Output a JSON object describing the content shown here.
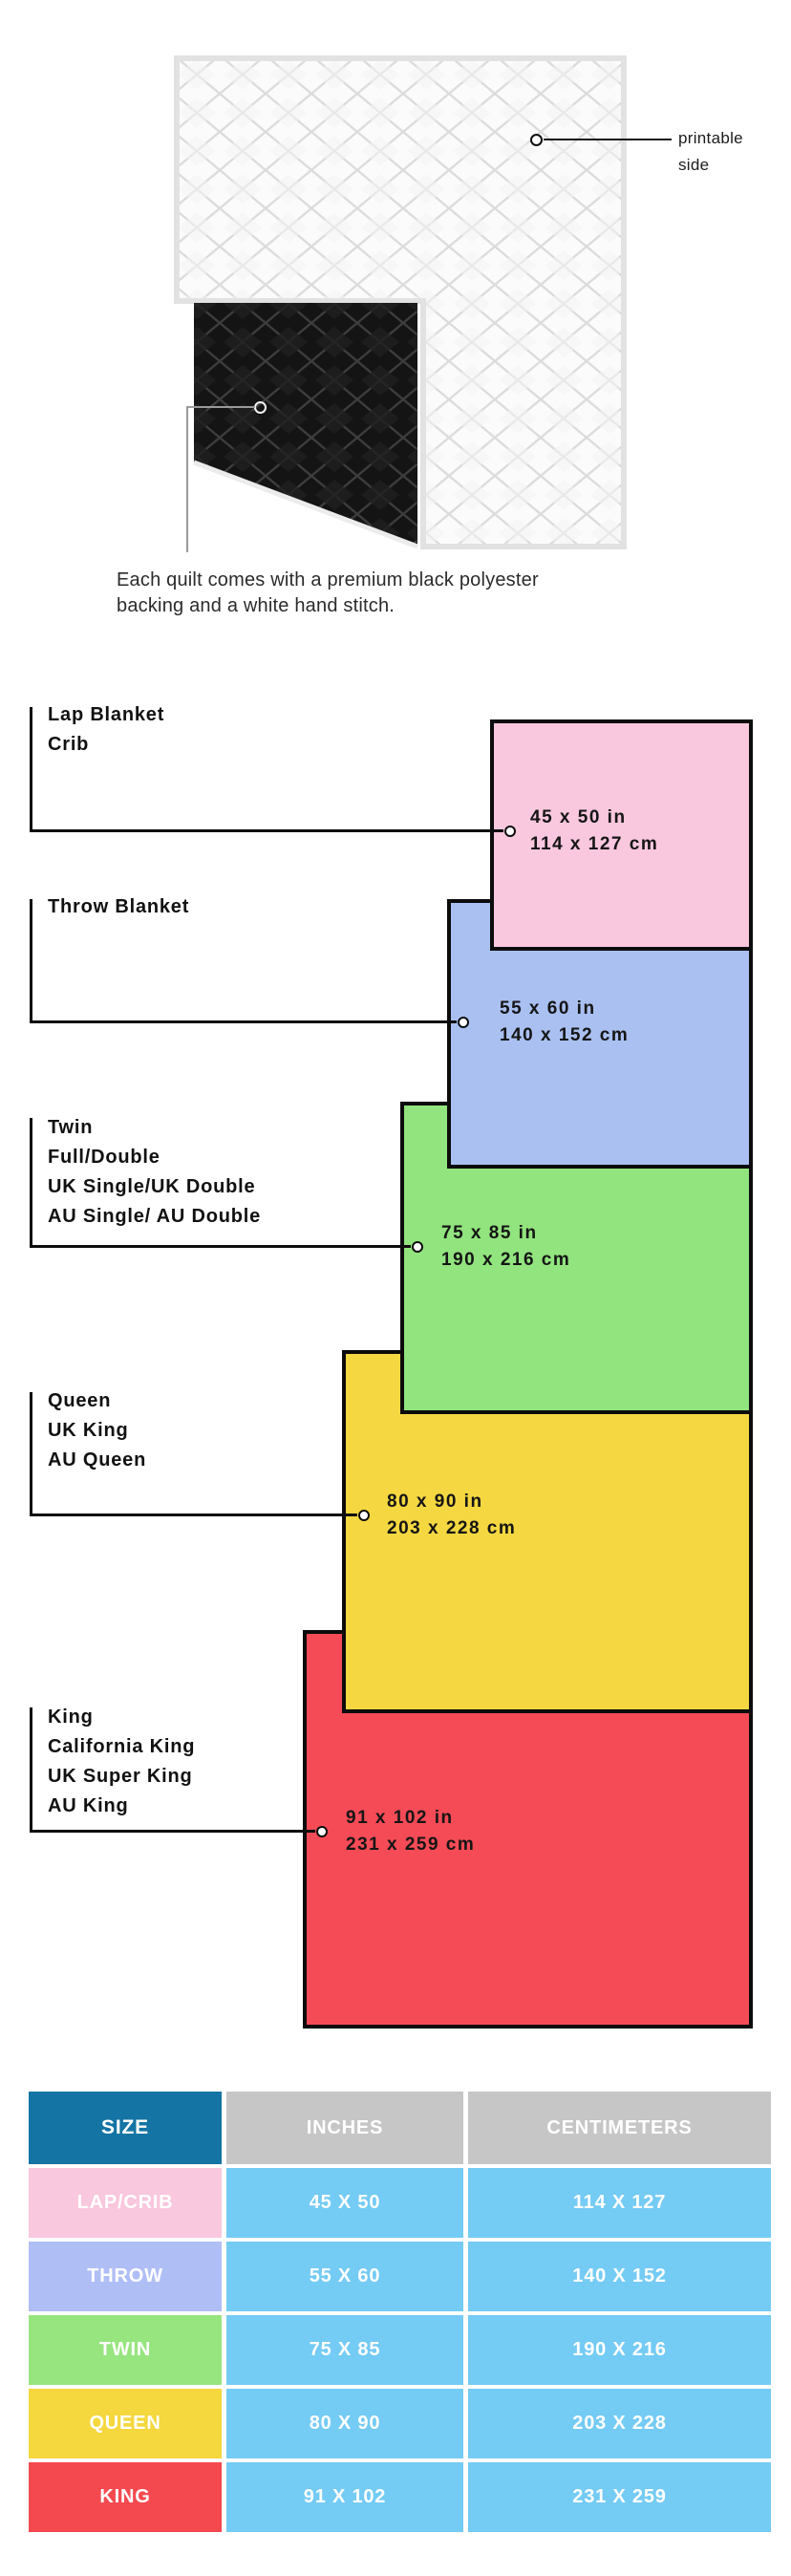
{
  "illustration": {
    "printable_side": {
      "line1": "printable",
      "line2": "side"
    },
    "caption_line1": "Each quilt comes with a premium black polyester",
    "caption_line2": "backing and a white hand stitch."
  },
  "diagram": {
    "sizes": [
      {
        "key": "lap",
        "label_lines": [
          "Lap Blanket",
          "Crib"
        ],
        "inches": "45 x 50 in",
        "cm": "114 x 127 cm",
        "fill": "#f9c7de"
      },
      {
        "key": "throw",
        "label_lines": [
          "Throw Blanket"
        ],
        "inches": "55 x 60 in",
        "cm": "140 x 152 cm",
        "fill": "#a9c0f1"
      },
      {
        "key": "twin",
        "label_lines": [
          "Twin",
          "Full/Double",
          "UK Single/UK Double",
          "AU Single/ AU Double"
        ],
        "inches": "75 x 85 in",
        "cm": "190 x 216 cm",
        "fill": "#92e47e"
      },
      {
        "key": "queen",
        "label_lines": [
          "Queen",
          "UK King",
          "AU Queen"
        ],
        "inches": "80 x 90 in",
        "cm": "203 x 228 cm",
        "fill": "#f5d841"
      },
      {
        "key": "king",
        "label_lines": [
          "King",
          "California King",
          "UK Super King",
          "AU King"
        ],
        "inches": "91 x 102 in",
        "cm": "231 x 259 cm",
        "fill": "#f54b56"
      }
    ],
    "overlap_colors": {
      "pink_blue": "#deb6e1",
      "blue_green": "#87b8da",
      "green_yellow": "#8ed452",
      "yellow_red": "#f0a72b"
    }
  },
  "table": {
    "headers": {
      "size": "SIZE",
      "inches": "INCHES",
      "centimeters": "CENTIMETERS"
    },
    "header_colors": {
      "size_bg": "#1474a4",
      "metric_bg": "#c6c6c6"
    },
    "data_cell_bg": "#74cbf4",
    "rows": [
      {
        "size": "LAP/CRIB",
        "inches": "45 X 50",
        "cm": "114 X 127",
        "color": "#f9c7de"
      },
      {
        "size": "THROW",
        "inches": "55 X 60",
        "cm": "140 X 152",
        "color": "#b0bef6"
      },
      {
        "size": "TWIN",
        "inches": "75 X 85",
        "cm": "190 X 216",
        "color": "#97e57e"
      },
      {
        "size": "QUEEN",
        "inches": "80 X 90",
        "cm": "203 X 228",
        "color": "#f5d73e"
      },
      {
        "size": "KING",
        "inches": "91 X 102",
        "cm": "231 X 259",
        "color": "#f4494f"
      }
    ]
  }
}
